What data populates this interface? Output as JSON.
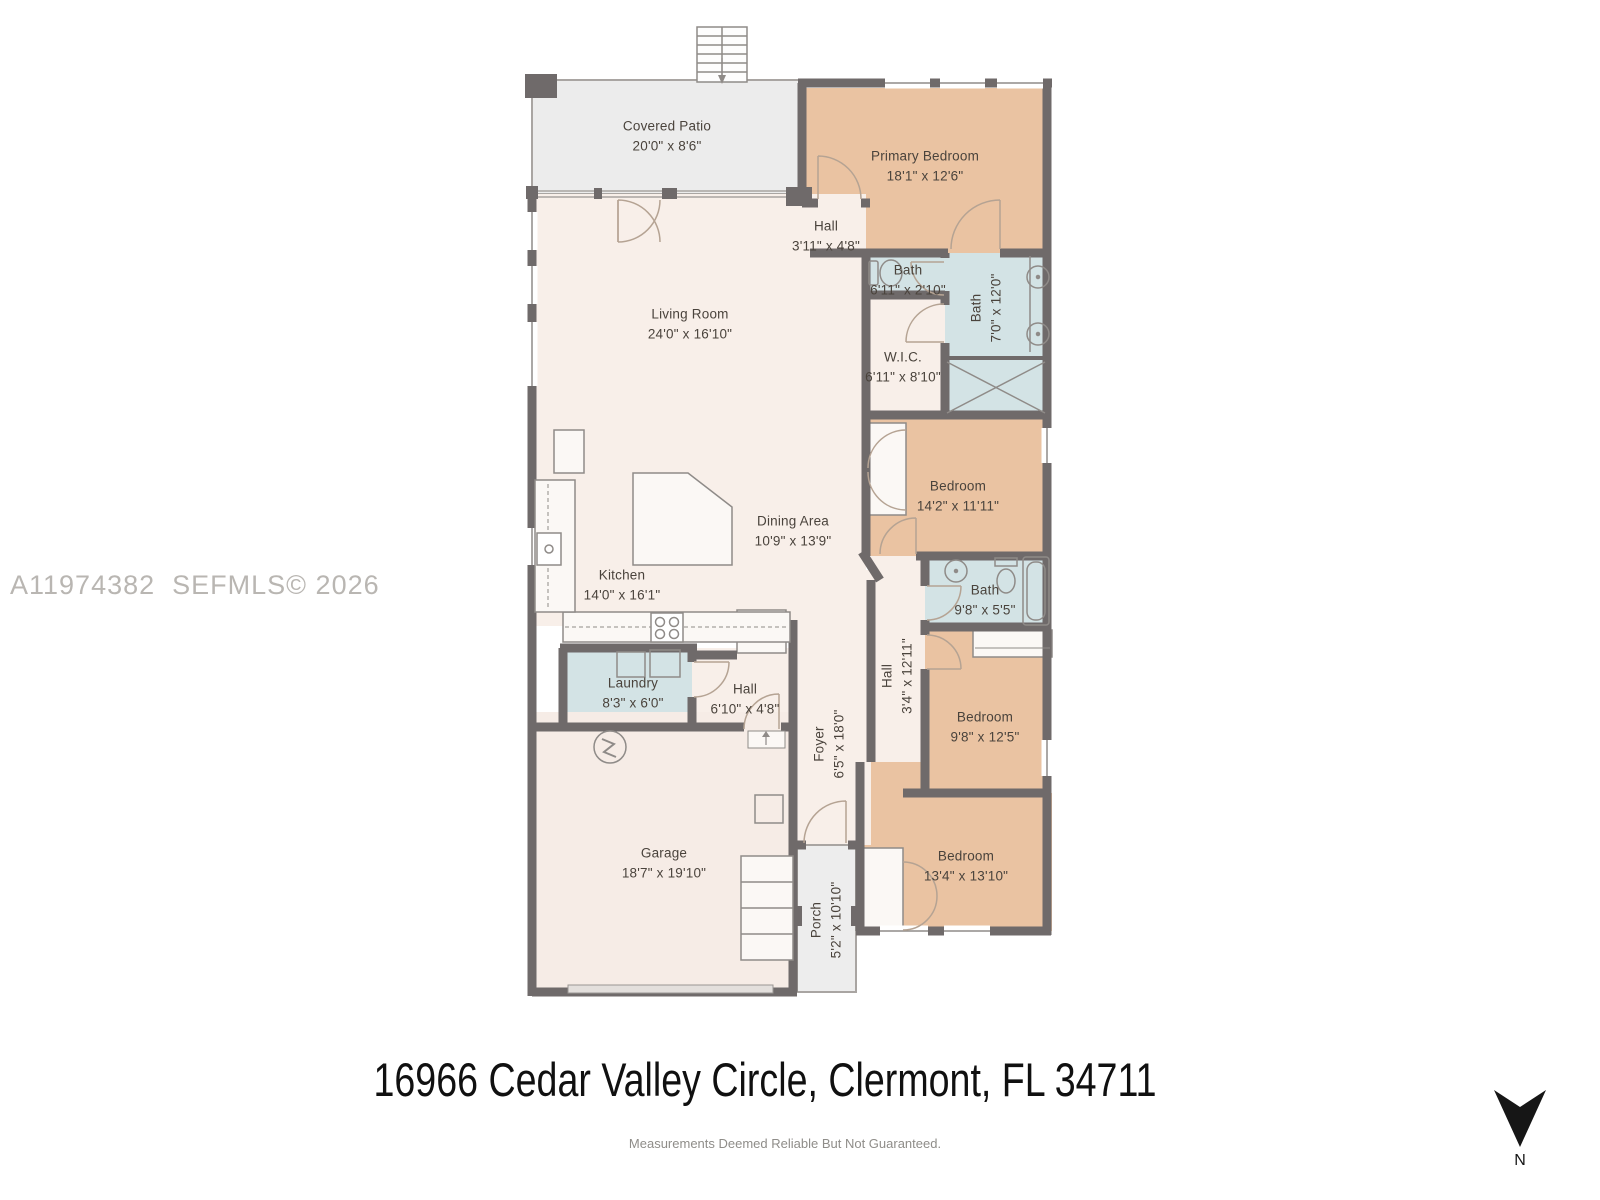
{
  "watermark": "A11974382  SEFMLS© 2026",
  "footer": {
    "title": "16966 Cedar Valley Circle, Clermont, FL 34711",
    "disclaimer": "Measurements Deemed Reliable But Not Guaranteed."
  },
  "compass": {
    "label": "N"
  },
  "colors": {
    "bedroom_fill": "#eac3a2",
    "bath_fill": "#d3e3e5",
    "floor_fill": "#f8efe9",
    "patio_fill": "#ececec",
    "closet_fill": "#fbf8f5",
    "wall": "#6f6a6a"
  },
  "rooms": {
    "covered_patio": {
      "name": "Covered Patio",
      "dims": "20'0\" x 8'6\""
    },
    "primary_bedroom": {
      "name": "Primary Bedroom",
      "dims": "18'1\" x 12'6\""
    },
    "hall_upper": {
      "name": "Hall",
      "dims": "3'11\" x 4'8\""
    },
    "bath_powder": {
      "name": "Bath",
      "dims": "6'11\" x 2'10\""
    },
    "bath_primary": {
      "name": "Bath",
      "dims": "7'0\" x 12'0\""
    },
    "wic": {
      "name": "W.I.C.",
      "dims": "6'11\" x 8'10\""
    },
    "living_room": {
      "name": "Living Room",
      "dims": "24'0\" x 16'10\""
    },
    "bedroom_2": {
      "name": "Bedroom",
      "dims": "14'2\" x 11'11\""
    },
    "dining_area": {
      "name": "Dining Area",
      "dims": "10'9\" x 13'9\""
    },
    "kitchen": {
      "name": "Kitchen",
      "dims": "14'0\" x 16'1\""
    },
    "bath_2": {
      "name": "Bath",
      "dims": "9'8\" x 5'5\""
    },
    "hall_center": {
      "name": "Hall",
      "dims": "3'4\" x 12'11\""
    },
    "laundry": {
      "name": "Laundry",
      "dims": "8'3\" x 6'0\""
    },
    "hall_lower": {
      "name": "Hall",
      "dims": "6'10\" x 4'8\""
    },
    "foyer": {
      "name": "Foyer",
      "dims": "6'5\" x 18'0\""
    },
    "bedroom_3": {
      "name": "Bedroom",
      "dims": "9'8\" x 12'5\""
    },
    "garage": {
      "name": "Garage",
      "dims": "18'7\" x 19'10\""
    },
    "bedroom_4": {
      "name": "Bedroom",
      "dims": "13'4\" x 13'10\""
    },
    "porch": {
      "name": "Porch",
      "dims": "5'2\" x 10'10\""
    }
  }
}
